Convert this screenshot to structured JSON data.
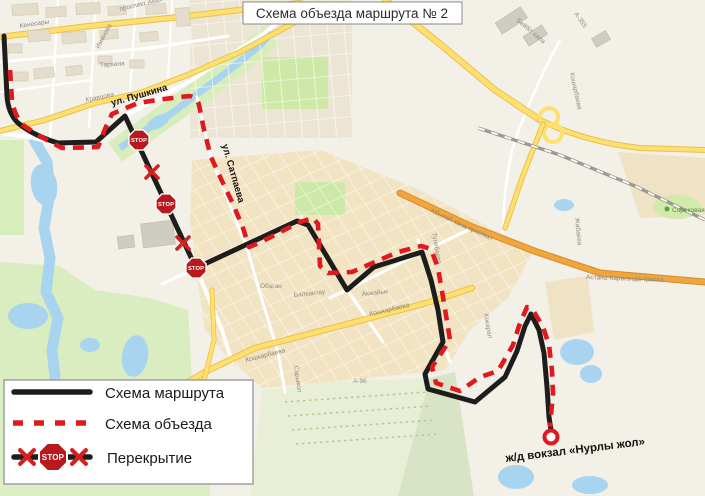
{
  "title": {
    "text": "Схема объезда маршрута № 2"
  },
  "legend": {
    "items": [
      {
        "label": "Схема маршрута"
      },
      {
        "label": "Схема объезда"
      },
      {
        "label": "Перекрытие"
      }
    ]
  },
  "route": {
    "stop_sign_text": "STOP",
    "station_label": "ж/д вокзал «Нурлы жол»"
  },
  "colors": {
    "route_black": "#1d1d1b",
    "detour_red": "#e0191f",
    "stop_sign_red": "#b8191e",
    "stop_x_red": "#d6201f",
    "water_blue": "#a9d4ef",
    "park_green": "#cfe7a6",
    "road_yellow": "#ffd95e",
    "road_orange": "#f2a53c",
    "land_beige": "#f3f0e8",
    "residential_tan": "#f2e3c3"
  },
  "map": {
    "highlight_labels": [
      {
        "text": "ул. Пушкина"
      },
      {
        "text": "ул. Сатпаева"
      }
    ],
    "street_labels": [
      {
        "text": "Кенесары"
      },
      {
        "text": "Иманова"
      },
      {
        "text": "Тархана"
      },
      {
        "text": "Кравцова"
      },
      {
        "text": "проспект Абая"
      },
      {
        "text": "Бейбіт кала"
      },
      {
        "text": "А-355"
      },
      {
        "text": "Кошарбаева"
      },
      {
        "text": "Сороковая"
      },
      {
        "text": "Астана-Караганда-трасса"
      },
      {
        "text": "Жабаева"
      },
      {
        "text": "Кошкарбаева"
      },
      {
        "text": "Кошкарбаева"
      },
      {
        "text": "Балкантау"
      },
      {
        "text": "Акжайык"
      },
      {
        "text": "А-96"
      },
      {
        "text": "Сарыкол"
      },
      {
        "text": "Обаган"
      },
      {
        "text": "Тулебаева"
      },
      {
        "text": "Кокарал"
      },
      {
        "text": "Абылай хана проспект"
      }
    ]
  }
}
